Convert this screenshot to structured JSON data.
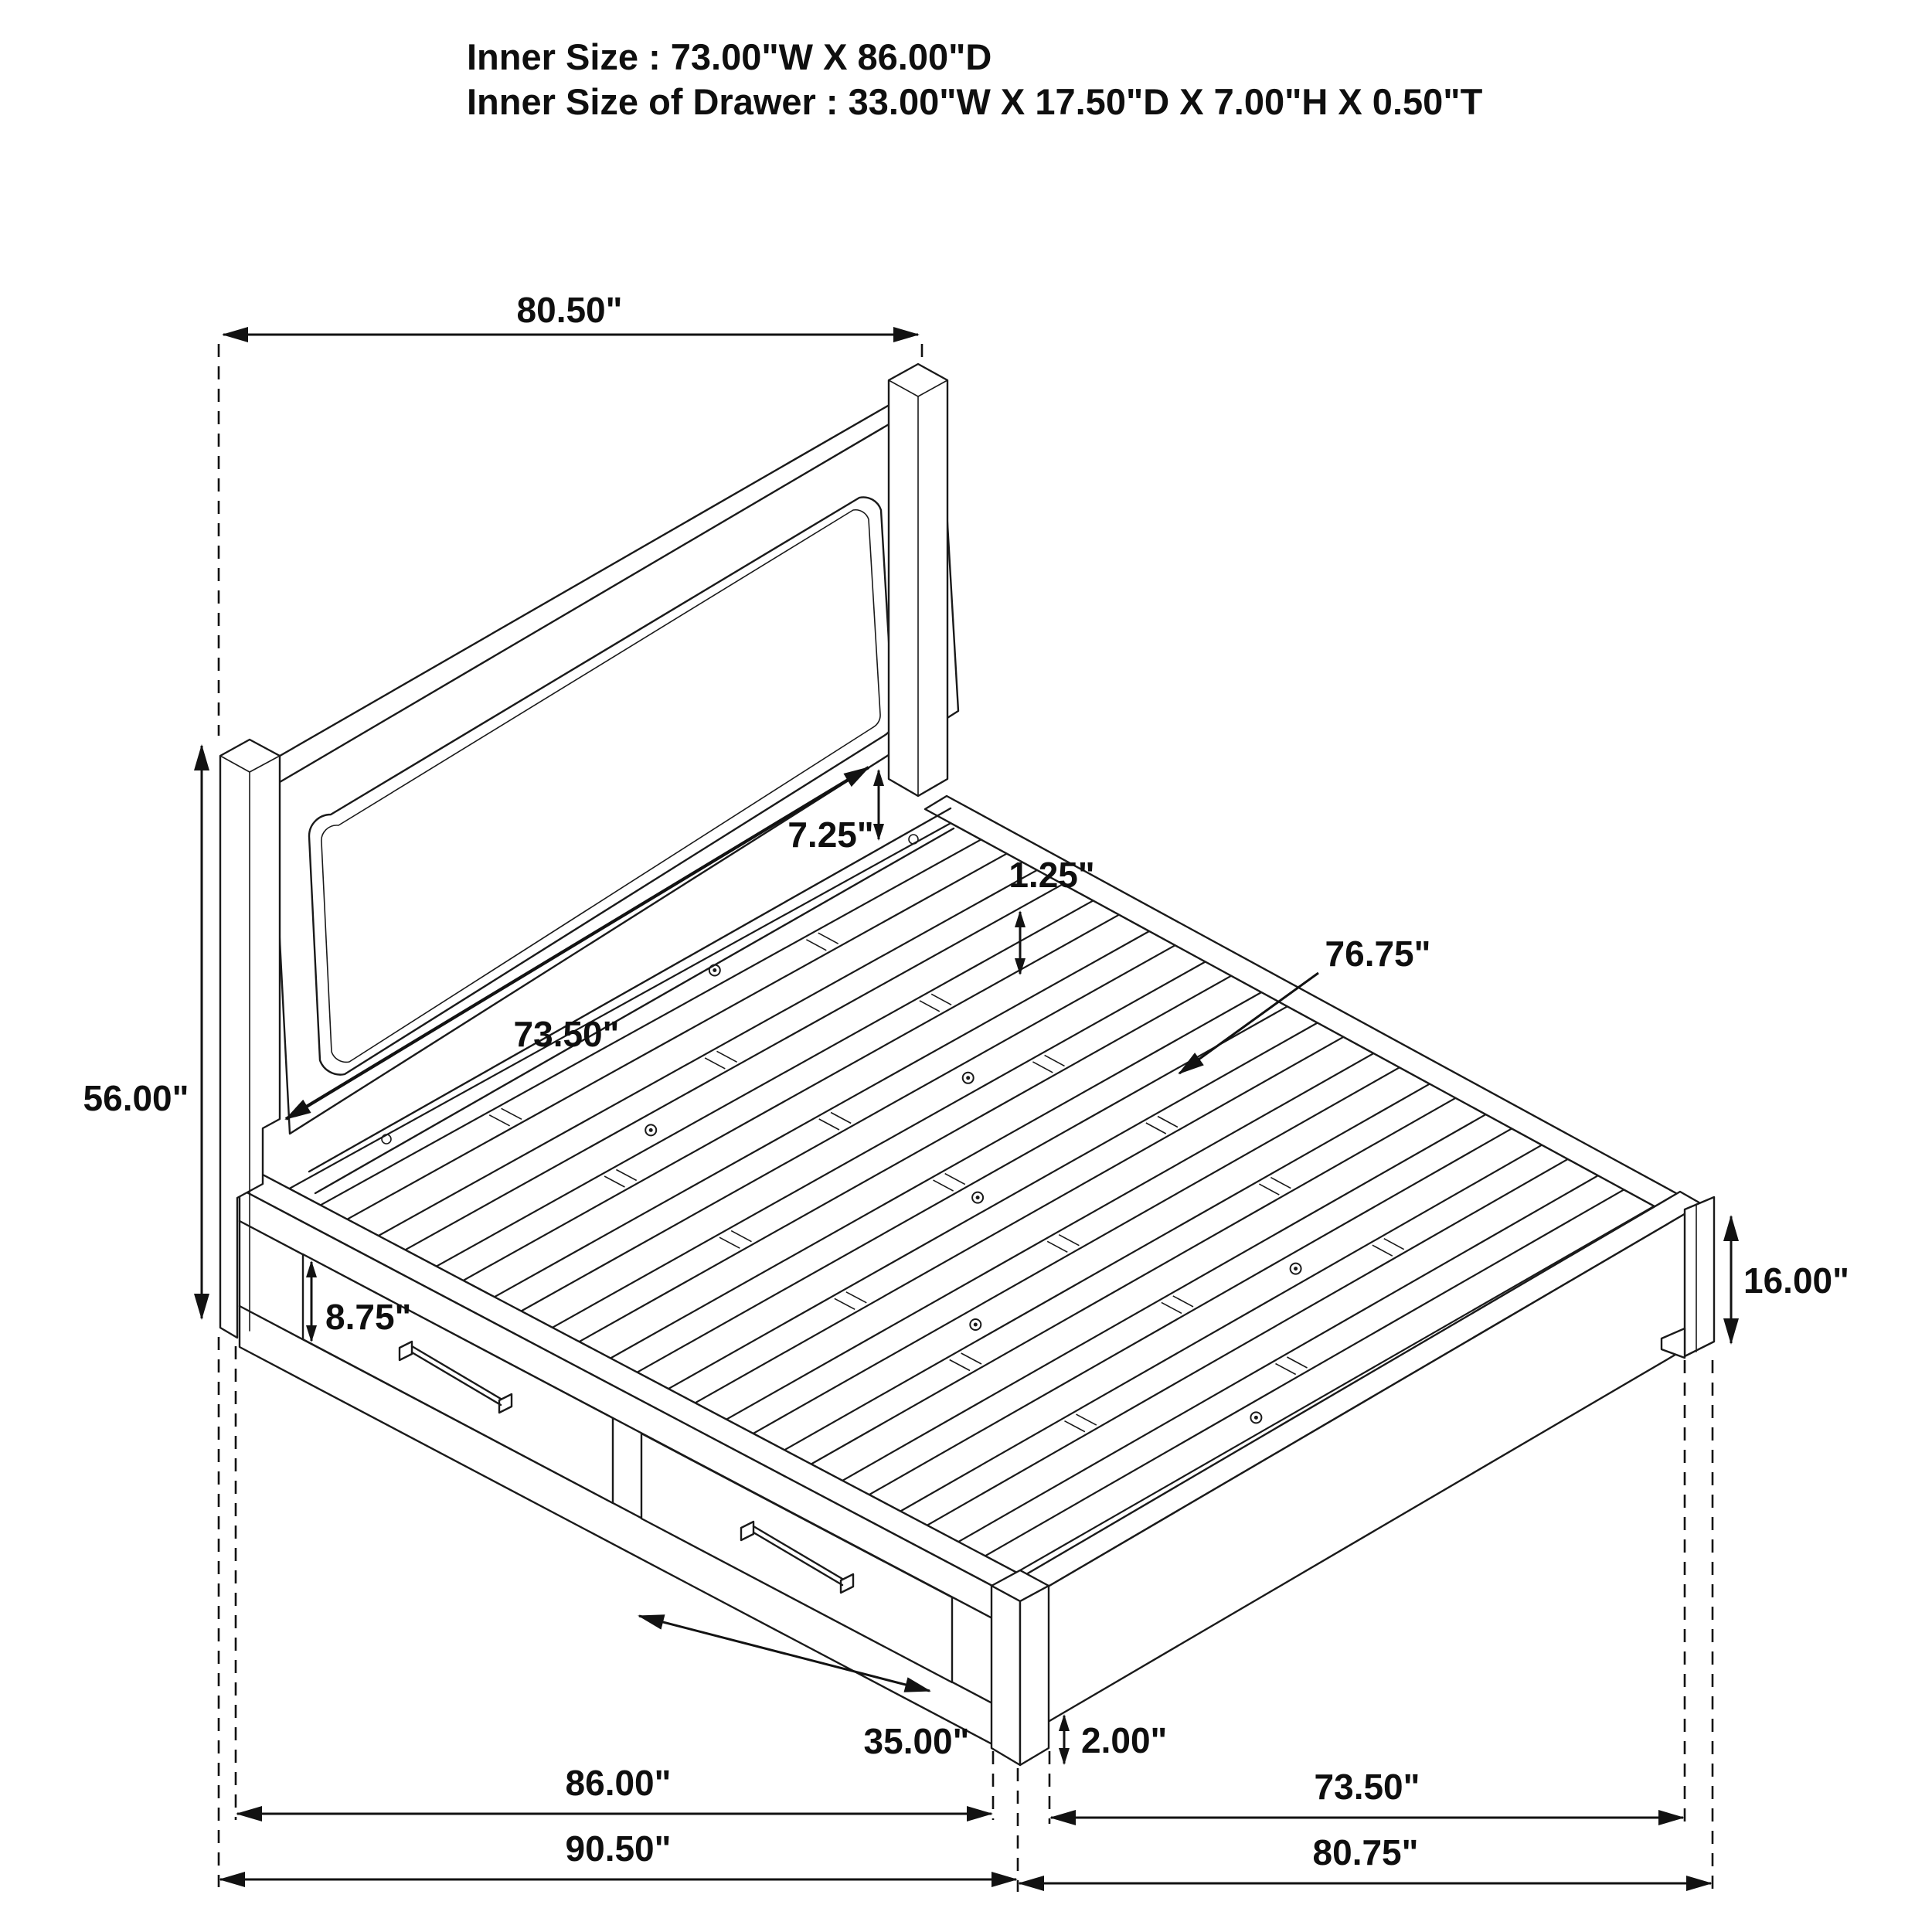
{
  "title": {
    "line1": "Inner Size : 73.00\"W X 86.00\"D",
    "line2": "Inner Size of Drawer : 33.00\"W X 17.50\"D X 7.00\"H X 0.50\"T"
  },
  "dimensions": {
    "headboard_width": "80.50\"",
    "headboard_height": "56.00\"",
    "headboard_inner_width": "73.50\"",
    "panel_to_rail_gap": "7.25\"",
    "slat_inset": "1.25\"",
    "slat_length": "76.75\"",
    "drawer_front_height": "8.75\"",
    "drawer_opening_width": "35.00\"",
    "frame_height": "16.00\"",
    "ground_clearance": "2.00\"",
    "inner_depth": "86.00\"",
    "overall_depth": "90.50\"",
    "foot_inner_width": "73.50\"",
    "foot_overall_width": "80.75\""
  },
  "colors": {
    "line": "#1a1a1a",
    "dimension": "#121212",
    "background": "#ffffff"
  }
}
